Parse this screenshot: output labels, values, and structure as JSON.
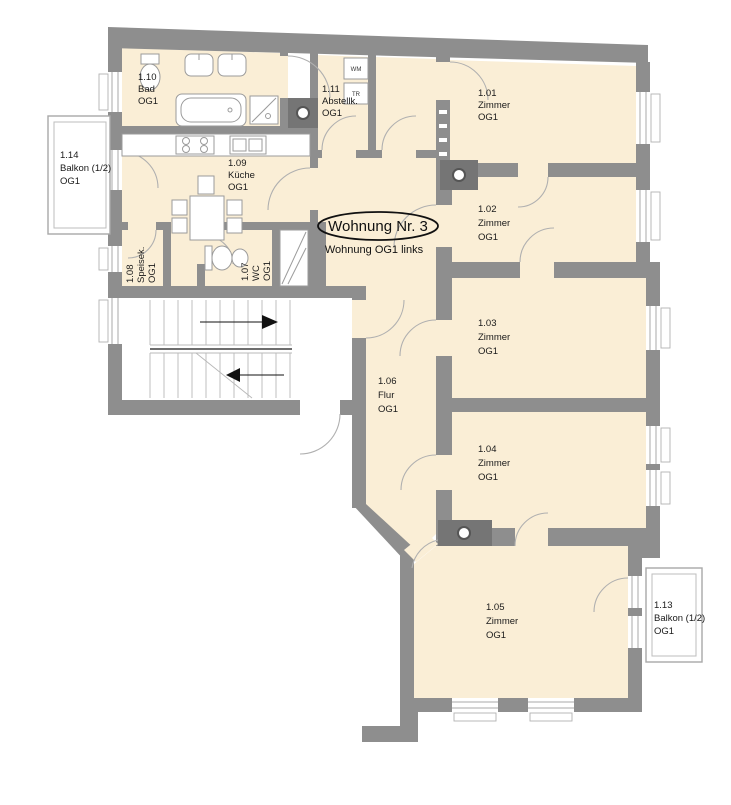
{
  "plan": {
    "title": "Wohnung Nr. 3",
    "subtitle": "Wohnung OG1 links",
    "rooms": {
      "zimmer1": {
        "number": "1.01",
        "name": "Zimmer",
        "level": "OG1"
      },
      "zimmer2": {
        "number": "1.02",
        "name": "Zimmer",
        "level": "OG1"
      },
      "zimmer3": {
        "number": "1.03",
        "name": "Zimmer",
        "level": "OG1"
      },
      "zimmer4": {
        "number": "1.04",
        "name": "Zimmer",
        "level": "OG1"
      },
      "zimmer5": {
        "number": "1.05",
        "name": "Zimmer",
        "level": "OG1"
      },
      "flur": {
        "number": "1.06",
        "name": "Flur",
        "level": "OG1"
      },
      "wc": {
        "number": "1.07",
        "name": "WC",
        "level": "OG1"
      },
      "speisekammer": {
        "number": "1.08",
        "name": "Speisek.",
        "level": "OG1"
      },
      "kueche": {
        "number": "1.09",
        "name": "Küche",
        "level": "OG1"
      },
      "bad": {
        "number": "1.10",
        "name": "Bad",
        "level": "OG1"
      },
      "abstellkammer": {
        "number": "1.11",
        "name": "Abstellk.",
        "level": "OG1"
      },
      "balkon_rechts": {
        "number": "1.13",
        "name": "Balkon (1/2)",
        "level": "OG1"
      },
      "balkon_links": {
        "number": "1.14",
        "name": "Balkon (1/2)",
        "level": "OG1"
      }
    },
    "appliances": {
      "washer": "WM",
      "dryer": "TR"
    },
    "colors": {
      "wall": "#8e8e8e",
      "chimney": "#757575",
      "room_fill": "#faeed6",
      "text": "#1a1a1a"
    }
  }
}
